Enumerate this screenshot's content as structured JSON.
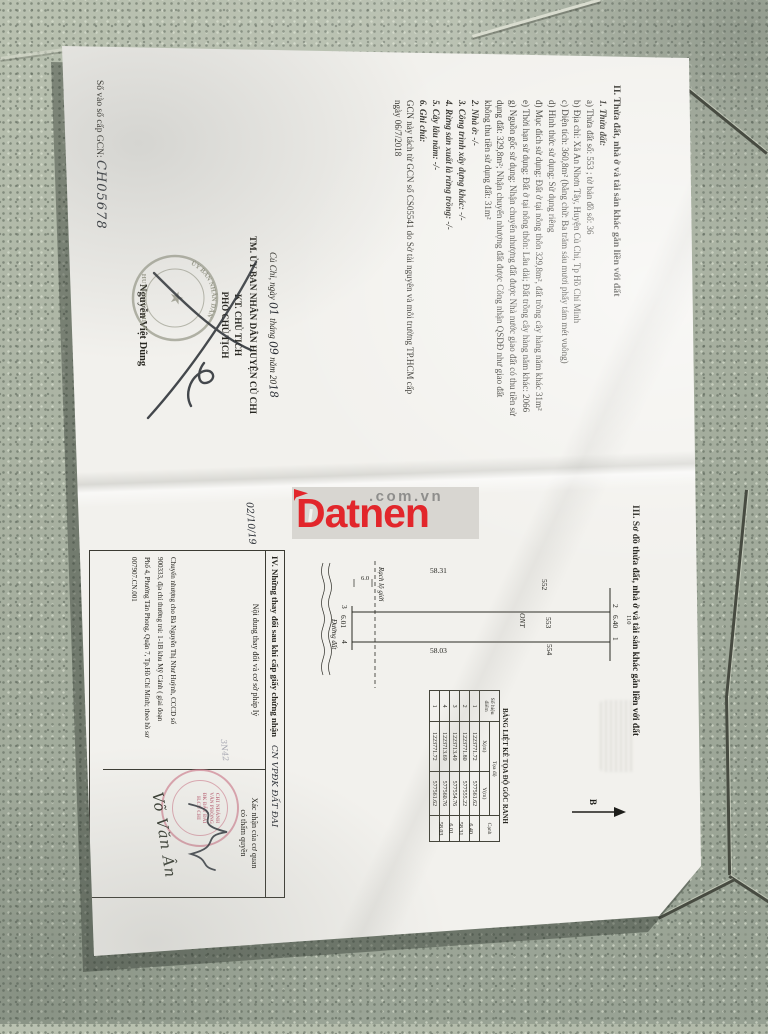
{
  "watermark": {
    "brand": "Datnen",
    "suffix": ".com.vn",
    "brand_color": "#e2262b",
    "suffix_color": "#8e8e8c"
  },
  "serial": {
    "label": "Số vào sổ cấp GCN:",
    "value": "CH05678"
  },
  "section2": {
    "heading": "II. Thửa đất, nhà ở và tài sản khác gắn liền với đất",
    "lines": [
      {
        "t": "1. Thửa đất:",
        "cls": "bi"
      },
      {
        "t": "a) Thửa đất số: 553 ; tờ bản đồ số: 36",
        "cls": ""
      },
      {
        "t": "b) Địa chỉ: Xã An Nhơn Tây, Huyện Củ Chi, Tp Hồ Chí Minh",
        "cls": ""
      },
      {
        "t": "c) Diện tích: 360,8m² (bằng chữ: Ba trăm sáu mươi phẩy tám mét vuông)",
        "cls": ""
      },
      {
        "t": "d) Hình thức sử dụng: Sử dụng riêng",
        "cls": ""
      },
      {
        "t": "đ) Mục đích sử dụng: Đất ở tại nông thôn 329,8m², đất trồng cây hàng năm khác 31m²",
        "cls": ""
      },
      {
        "t": "e) Thời hạn sử dụng: Đất ở tại nông thôn: Lâu dài; Đất trồng cây hàng năm khác: 2066",
        "cls": ""
      },
      {
        "t": "g) Nguồn gốc sử dụng: Nhận chuyển nhượng đất được Nhà nước giao đất có thu tiền sử",
        "cls": ""
      },
      {
        "t": "dụng đất: 329,8m²; Nhận chuyển nhượng đất được Công nhận QSDĐ như giao đất",
        "cls": ""
      },
      {
        "t": "không thu tiền sử dụng đất: 31m²",
        "cls": ""
      },
      {
        "t": "2. Nhà ở: -/-",
        "cls": "bi"
      },
      {
        "t": "3. Công trình xây dựng khác: -/-",
        "cls": "bi"
      },
      {
        "t": "4. Rừng sản xuất là rừng trồng: -/-",
        "cls": "bi"
      },
      {
        "t": "5. Cây lâu năm: -/-",
        "cls": "bi"
      },
      {
        "t": "6. Ghi chú:",
        "cls": "bi"
      },
      {
        "t": "GCN này tách từ GCN số  CS05541 do Sở tài nguyên và môi trường TP.HCM  cấp",
        "cls": ""
      },
      {
        "t": "ngày 06/7/2018",
        "cls": ""
      }
    ]
  },
  "sign_block": {
    "place": "Củ Chi, ngày",
    "day": "01",
    "mid1": "tháng",
    "month": "09",
    "mid2": "năm 20",
    "year": "18",
    "line1": "TM. ỦY BAN NHÂN DÂN HUYỆN CỦ CHI",
    "line2": "KT. CHỦ TỊCH",
    "line3": "PHÓ CHỦ TỊCH",
    "signer": "Nguyễn Việt Dũng",
    "stamp_arc": "ỦY BAN NHÂN DÂN",
    "stamp_line": "HUYỆN CỦ CHI",
    "stamp_star": "★"
  },
  "section3": {
    "heading": "III. Sơ đồ thửa đất, nhà ở và tài sản khác gắn liền với đất",
    "diagram": {
      "parcel_left": "552",
      "parcel_mid": "553",
      "parcel_right": "554",
      "land_use": "ONT",
      "corner_tl": "2",
      "corner_tr": "1",
      "corner_bl": "3",
      "corner_br": "4",
      "top_len": "6.40",
      "bottom_len": "6.01",
      "left_len": "58.31",
      "right_len": "58.03",
      "adjacent": "110",
      "setback_label": "Rạch lộ giới",
      "setback_gap": "6.0",
      "road_label": "Đường đất",
      "north": "B"
    },
    "coord_table": {
      "title": "BẢNG LIỆT KÊ TỌA ĐỘ GÓC RANH",
      "col_point_1": "Số hiệu",
      "col_point_2": "điểm",
      "col_coord": "Tọa độ",
      "col_x": "X(m)",
      "col_y": "Y(m)",
      "col_edge": "Cạnh",
      "rows": [
        [
          "1",
          "1223771.72",
          "577561.62",
          "6.40"
        ],
        [
          "2",
          "1223771.80",
          "577555.22",
          "58.31"
        ],
        [
          "3",
          "1223713.49",
          "577554.76",
          "6.01"
        ],
        [
          "4",
          "1223713.69",
          "577560.76",
          "58.03"
        ],
        [
          "1",
          "1223771.72",
          "577561.62",
          ""
        ]
      ]
    }
  },
  "section4": {
    "heading": "IV. Những thay đổi sau khi cấp giấy chứng nhận",
    "heading_hand": "CN VPĐK ĐẤT ĐAI",
    "col_content": "Nội dung thay đổi và cơ sở pháp lý",
    "col_confirm_1": "Xác nhận của cơ quan",
    "col_confirm_2": "có thẩm quyền",
    "date_hand": "02/10/19",
    "note_hand": "3N42",
    "content_lines": [
      "Chuyển nhượng cho Bà Nguyễn Thị Như Huỳnh, CCCD số",
      "900333, địa chỉ thường trú: 1-1B  khu Mỹ Cảnh ( giai đoạn",
      "Phố 4, Phường Tân Phong, Quận 7, Tp.Hồ Chí Minh; theo hồ sơ",
      "007907.CN.001"
    ],
    "signer_hand": "Võ Văn Ân",
    "stamp_lines": [
      "CHI NHÁNH",
      "VĂN PHÒNG",
      "ĐK ĐẤT ĐAI",
      "H.CỦ CHI"
    ]
  }
}
